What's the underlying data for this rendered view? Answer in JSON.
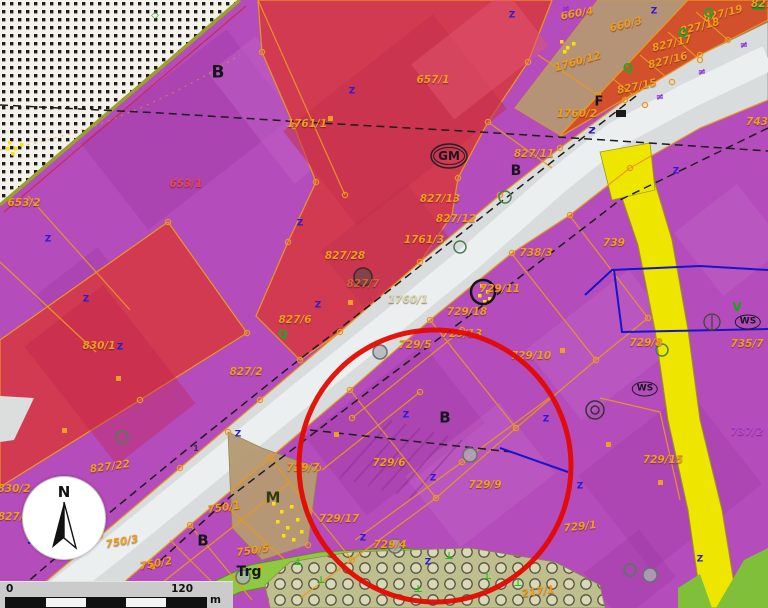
{
  "map": {
    "type": "cadastral-zoning-map",
    "colors": {
      "zone_purple": "#b54cbb",
      "zone_red": "#d23a52",
      "zone_orange": "#d2512c",
      "zone_tan": "#b59a72",
      "road_gray": "#d9dcdc",
      "road_yellow": "#efe600",
      "green_public": "#8fc93f",
      "orchard_olive": "#bfbf8e",
      "parcel_line_orange": "#e8991c",
      "label_orange": "#f09e1c",
      "annotation_red": "#e40800"
    },
    "annotation_circle": {
      "cx": 435,
      "cy": 466,
      "r": 136,
      "color": "#e40800",
      "stroke_width": 5
    },
    "north_arrow": {
      "label": "N"
    },
    "scale_bar": {
      "start": "0",
      "end": "120",
      "unit": "m",
      "segments": 5
    },
    "parcel_labels": [
      {
        "text": "660/4",
        "x": 577,
        "y": 14,
        "rot": -10
      },
      {
        "text": "660/3",
        "x": 626,
        "y": 25,
        "rot": -14
      },
      {
        "text": "827/19",
        "x": 723,
        "y": 14,
        "rot": -14
      },
      {
        "text": "827/18",
        "x": 700,
        "y": 27,
        "rot": -14
      },
      {
        "text": "827/17",
        "x": 672,
        "y": 44,
        "rot": -14
      },
      {
        "text": "827/16",
        "x": 668,
        "y": 61,
        "rot": -14
      },
      {
        "text": "827/15",
        "x": 637,
        "y": 87,
        "rot": -12
      },
      {
        "text": "827",
        "x": 762,
        "y": 4
      },
      {
        "text": "1760/12",
        "x": 578,
        "y": 62,
        "rot": -16
      },
      {
        "text": "1760/2",
        "x": 577,
        "y": 114
      },
      {
        "text": "657/1",
        "x": 433,
        "y": 80
      },
      {
        "text": "1761/1",
        "x": 307,
        "y": 124
      },
      {
        "text": "653/1",
        "x": 186,
        "y": 184,
        "color": "#e8474e"
      },
      {
        "text": "653/2",
        "x": 24,
        "y": 203
      },
      {
        "text": "827/11",
        "x": 534,
        "y": 154
      },
      {
        "text": "827/13",
        "x": 440,
        "y": 199
      },
      {
        "text": "827/12",
        "x": 456,
        "y": 219
      },
      {
        "text": "1761/3",
        "x": 424,
        "y": 240
      },
      {
        "text": "827/28",
        "x": 345,
        "y": 256
      },
      {
        "text": "827/7",
        "x": 363,
        "y": 284,
        "color": "#c96a3a"
      },
      {
        "text": "1760/1",
        "x": 408,
        "y": 300,
        "color": "#d9d9ad"
      },
      {
        "text": "827/6",
        "x": 295,
        "y": 320
      },
      {
        "text": "827/2",
        "x": 246,
        "y": 372
      },
      {
        "text": "830/1",
        "x": 99,
        "y": 346
      },
      {
        "text": "830/2",
        "x": 14,
        "y": 489
      },
      {
        "text": "827/24",
        "x": 18,
        "y": 517
      },
      {
        "text": "827/22",
        "x": 110,
        "y": 467,
        "rot": -8
      },
      {
        "text": "738/3",
        "x": 536,
        "y": 253
      },
      {
        "text": "739",
        "x": 614,
        "y": 243
      },
      {
        "text": "743",
        "x": 757,
        "y": 122
      },
      {
        "text": "729/11",
        "x": 500,
        "y": 289
      },
      {
        "text": "729/18",
        "x": 467,
        "y": 312
      },
      {
        "text": "729/13",
        "x": 462,
        "y": 334
      },
      {
        "text": "729/5",
        "x": 415,
        "y": 345
      },
      {
        "text": "729/10",
        "x": 531,
        "y": 356
      },
      {
        "text": "729/8",
        "x": 646,
        "y": 343
      },
      {
        "text": "735/7",
        "x": 747,
        "y": 344
      },
      {
        "text": "729/7",
        "x": 303,
        "y": 468
      },
      {
        "text": "729/6",
        "x": 389,
        "y": 463
      },
      {
        "text": "729/9",
        "x": 485,
        "y": 485
      },
      {
        "text": "729/17",
        "x": 339,
        "y": 519
      },
      {
        "text": "729/4",
        "x": 390,
        "y": 545
      },
      {
        "text": "729/15",
        "x": 663,
        "y": 460
      },
      {
        "text": "729/1",
        "x": 580,
        "y": 527,
        "rot": -6
      },
      {
        "text": "737/2",
        "x": 747,
        "y": 432,
        "color": "#b84ae0"
      },
      {
        "text": "217/1",
        "x": 538,
        "y": 592,
        "rot": -8
      },
      {
        "text": "750/1",
        "x": 224,
        "y": 508,
        "rot": -8
      },
      {
        "text": "750/3",
        "x": 122,
        "y": 542,
        "rot": -10
      },
      {
        "text": "750/2",
        "x": 156,
        "y": 564,
        "rot": -10
      },
      {
        "text": "750/4",
        "x": 150,
        "y": 589,
        "rot": -8
      },
      {
        "text": "750/5",
        "x": 253,
        "y": 551,
        "rot": -8
      }
    ],
    "zone_labels": [
      {
        "text": "B",
        "x": 218,
        "y": 73,
        "size": 17
      },
      {
        "text": "B",
        "x": 516,
        "y": 171,
        "size": 14
      },
      {
        "text": "B",
        "x": 445,
        "y": 418,
        "size": 15
      },
      {
        "text": "B",
        "x": 203,
        "y": 541,
        "size": 15
      },
      {
        "text": "F",
        "x": 599,
        "y": 102,
        "size": 13
      },
      {
        "text": "GM",
        "x": 449,
        "y": 156,
        "size": 12,
        "circled": true
      },
      {
        "text": "M",
        "x": 273,
        "y": 498,
        "size": 15,
        "color": "#2f3b14"
      },
      {
        "text": "WS",
        "x": 748,
        "y": 322,
        "size": 9,
        "circled": true
      },
      {
        "text": "WS",
        "x": 645,
        "y": 389,
        "size": 9,
        "circled": true
      },
      {
        "text": "Trg",
        "x": 249,
        "y": 572,
        "size": 14
      },
      {
        "text": "V",
        "x": 737,
        "y": 307,
        "size": 12,
        "color": "#17a517"
      },
      {
        "text": "1",
        "x": 196,
        "y": 449,
        "size": 8,
        "color": "#333333"
      }
    ],
    "glyph_sets": [
      {
        "name": "tree-q-icon",
        "glyph": "Q",
        "color": "#28a12e",
        "size": 12,
        "positions": [
          [
            628,
            68
          ],
          [
            683,
            33
          ],
          [
            709,
            13
          ],
          [
            283,
            334
          ]
        ]
      },
      {
        "name": "utility-mark-icon",
        "glyph": "Z",
        "color": "#2a1ad4",
        "size": 9,
        "positions": [
          [
            352,
            92
          ],
          [
            512,
            16
          ],
          [
            654,
            12
          ],
          [
            300,
            224
          ],
          [
            318,
            306
          ],
          [
            406,
            416
          ],
          [
            433,
            479
          ],
          [
            363,
            539
          ],
          [
            546,
            420
          ],
          [
            592,
            132
          ],
          [
            120,
            348
          ],
          [
            48,
            240
          ],
          [
            676,
            172
          ],
          [
            428,
            563
          ],
          [
            700,
            560
          ],
          [
            238,
            435
          ],
          [
            580,
            487
          ],
          [
            86,
            300
          ]
        ]
      },
      {
        "name": "fence-mark-icon",
        "glyph": "≠",
        "color": "#8a2bd8",
        "size": 10,
        "positions": [
          [
            660,
            98
          ],
          [
            702,
            73
          ],
          [
            744,
            46
          ],
          [
            566,
            10
          ]
        ]
      },
      {
        "name": "tree-mark-icon",
        "glyph": "⊥",
        "color": "#12c418",
        "size": 10,
        "positions": [
          [
            298,
            563
          ],
          [
            321,
            581
          ],
          [
            449,
            557
          ],
          [
            487,
            577
          ],
          [
            418,
            590
          ],
          [
            518,
            584
          ]
        ]
      },
      {
        "name": "diamond-mark-icon",
        "glyph": "◇",
        "color": "#28a12e",
        "size": 10,
        "positions": [
          [
            155,
            16
          ]
        ]
      }
    ]
  }
}
